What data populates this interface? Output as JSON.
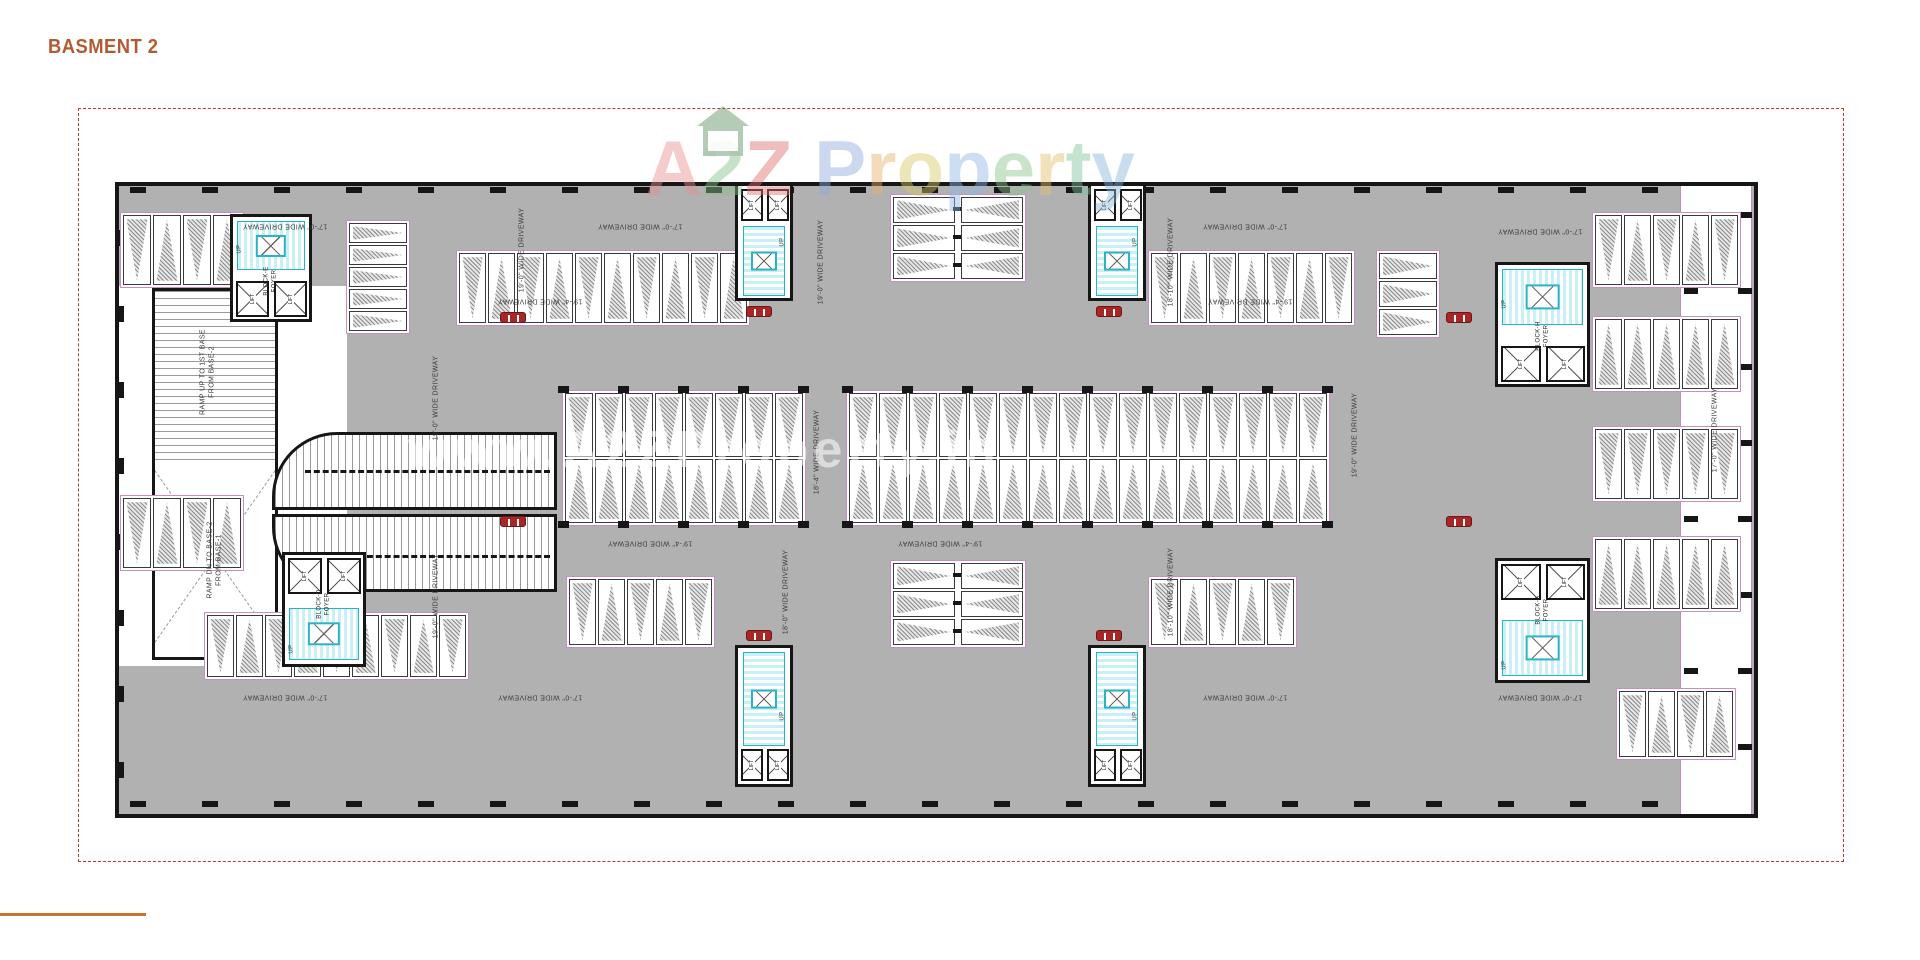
{
  "page": {
    "title": "BASMENT 2",
    "colors": {
      "title": "#b45a32",
      "footer_rule": "#c4742f",
      "boundary": "#c0392b",
      "driveway": "#b2b1b2",
      "wall": "#161616",
      "bay_outline": "#c490c4",
      "hatch": "#8d8d8d",
      "stair_line": "#2bb3c4",
      "stair_fill": "#c8f0f5",
      "car": "#a82626",
      "label": "#3a3a3a"
    }
  },
  "watermark": {
    "brand_letters": [
      {
        "ch": "A",
        "color": "#e78f8f"
      },
      {
        "ch": "2",
        "color": "#85c285"
      },
      {
        "ch": "Z",
        "color": "#e06e6e"
      },
      {
        "ch": " ",
        "color": "#ffffff"
      },
      {
        "ch": "P",
        "color": "#8fa8e0"
      },
      {
        "ch": "r",
        "color": "#e8b06a"
      },
      {
        "ch": "o",
        "color": "#d9c866"
      },
      {
        "ch": "p",
        "color": "#8fb6e8"
      },
      {
        "ch": "e",
        "color": "#8cc48c"
      },
      {
        "ch": "r",
        "color": "#e3c06a"
      },
      {
        "ch": "t",
        "color": "#7fc29b"
      },
      {
        "ch": "y",
        "color": "#86b6da"
      }
    ],
    "url": "www.A2ZProperty.in"
  },
  "plan": {
    "lift_label": "LIFT",
    "up_label": "UP",
    "ramp_labels": {
      "up": "RAMP UP TO 1ST BASE\nFROM BASE-2",
      "down": "RAMP DN TO BASE-2\nFROM BASE-1"
    },
    "driveway_labels": [
      {
        "text": "17'-0\" WIDE DRIVEWAY",
        "x": 285,
        "y": 225,
        "rot": 180
      },
      {
        "text": "17'-0\" WIDE DRIVEWAY",
        "x": 640,
        "y": 225,
        "rot": 180
      },
      {
        "text": "17'-0\" WIDE DRIVEWAY",
        "x": 1245,
        "y": 225,
        "rot": 180
      },
      {
        "text": "17'-0\" WIDE DRIVEWAY",
        "x": 1540,
        "y": 230,
        "rot": 180
      },
      {
        "text": "19'-4\" WIDE DRIVEWAY",
        "x": 540,
        "y": 300,
        "rot": 180
      },
      {
        "text": "19'-4\" WIDE DRIVEWAY",
        "x": 1250,
        "y": 300,
        "rot": 180
      },
      {
        "text": "19'-4\" WIDE DRIVEWAY",
        "x": 650,
        "y": 542,
        "rot": 180
      },
      {
        "text": "19'-4\" WIDE DRIVEWAY",
        "x": 940,
        "y": 542,
        "rot": 180
      },
      {
        "text": "17'-0\" WIDE DRIVEWAY",
        "x": 285,
        "y": 696,
        "rot": 180
      },
      {
        "text": "17'-0\" WIDE DRIVEWAY",
        "x": 540,
        "y": 696,
        "rot": 180
      },
      {
        "text": "17'-0\" WIDE DRIVEWAY",
        "x": 1245,
        "y": 696,
        "rot": 180
      },
      {
        "text": "17'-0\" WIDE DRIVEWAY",
        "x": 1540,
        "y": 696,
        "rot": 180
      },
      {
        "text": "19'-0\" WIDE DRIVEWAY",
        "x": 523,
        "y": 250,
        "rot": -90
      },
      {
        "text": "19'-0\" WIDE DRIVEWAY",
        "x": 822,
        "y": 262,
        "rot": -90
      },
      {
        "text": "18'-10\" WIDE DRIVEWAY",
        "x": 1172,
        "y": 262,
        "rot": -90
      },
      {
        "text": "19'-0\" WIDE DRIVEWAY",
        "x": 437,
        "y": 398,
        "rot": -90
      },
      {
        "text": "18'-4\" WIDE DRIVEWAY",
        "x": 818,
        "y": 452,
        "rot": -90
      },
      {
        "text": "19'-0\" WIDE DRIVEWAY",
        "x": 1356,
        "y": 435,
        "rot": -90
      },
      {
        "text": "19'-0\" WIDE DRIVEWAY",
        "x": 437,
        "y": 596,
        "rot": -90
      },
      {
        "text": "18'-0\" WIDE DRIVEWAY",
        "x": 787,
        "y": 592,
        "rot": -90
      },
      {
        "text": "18'-10\" WIDE DRIVEWAY",
        "x": 1172,
        "y": 592,
        "rot": -90
      },
      {
        "text": "17'-0\" WIDE DRIVEWAY",
        "x": 1716,
        "y": 430,
        "rot": -90
      }
    ],
    "cores": [
      {
        "id": "block-e-core",
        "label": "BLOCK-E\nFOYER",
        "x": 230,
        "y": 214,
        "w": 82,
        "h": 108,
        "stair": "top",
        "orient": "h"
      },
      {
        "id": "block-d-core",
        "label": "BLOCK-D\nFOYER",
        "x": 282,
        "y": 552,
        "w": 84,
        "h": 115,
        "stair": "bottom",
        "orient": "h"
      },
      {
        "id": "block-h-core",
        "label": "BLOCK-H\nFOYER",
        "x": 1495,
        "y": 262,
        "w": 95,
        "h": 125,
        "stair": "top",
        "orient": "h"
      },
      {
        "id": "block-a-core",
        "label": "BLOCK-A\nFOYER",
        "x": 1495,
        "y": 558,
        "w": 95,
        "h": 125,
        "stair": "bottom",
        "orient": "h"
      },
      {
        "id": "stair-core-top-1",
        "label": "",
        "x": 735,
        "y": 183,
        "w": 58,
        "h": 118,
        "stair": "bottom",
        "orient": "v"
      },
      {
        "id": "stair-core-top-2",
        "label": "",
        "x": 1088,
        "y": 183,
        "w": 58,
        "h": 118,
        "stair": "bottom",
        "orient": "v"
      },
      {
        "id": "stair-core-bottom-1",
        "label": "",
        "x": 735,
        "y": 645,
        "w": 58,
        "h": 142,
        "stair": "top",
        "orient": "v"
      },
      {
        "id": "stair-core-bottom-2",
        "label": "",
        "x": 1088,
        "y": 645,
        "w": 58,
        "h": 142,
        "stair": "top",
        "orient": "v"
      }
    ],
    "stall_groups": [
      {
        "id": "top-left-row",
        "type": "v",
        "x": 120,
        "y": 212,
        "n": 4,
        "sw": 28,
        "sh": 70,
        "apex": "alt"
      },
      {
        "id": "left-upper-stack",
        "type": "h",
        "x": 346,
        "y": 220,
        "n": 5,
        "sw": 58,
        "sh": 20,
        "apex": "right"
      },
      {
        "id": "top-row-1",
        "type": "v",
        "x": 456,
        "y": 250,
        "n": 10,
        "sw": 27,
        "sh": 70,
        "apex": "alt"
      },
      {
        "id": "top-center-island",
        "type": "hgrid",
        "x": 890,
        "y": 194,
        "cols": 2,
        "rows": 3,
        "sw": 62,
        "sh": 26
      },
      {
        "id": "top-row-2",
        "type": "v",
        "x": 1148,
        "y": 250,
        "n": 7,
        "sw": 27,
        "sh": 70,
        "apex": "alt"
      },
      {
        "id": "right-upper-stack",
        "type": "h",
        "x": 1376,
        "y": 250,
        "n": 3,
        "sw": 58,
        "sh": 26,
        "apex": "right"
      },
      {
        "id": "top-right-row",
        "type": "v",
        "x": 1592,
        "y": 212,
        "n": 5,
        "sw": 27,
        "sh": 70,
        "apex": "alt"
      },
      {
        "id": "right-row-1",
        "type": "v",
        "x": 1592,
        "y": 316,
        "n": 5,
        "sw": 27,
        "sh": 70,
        "apex": "up"
      },
      {
        "id": "right-row-2",
        "type": "v",
        "x": 1592,
        "y": 426,
        "n": 5,
        "sw": 27,
        "sh": 70,
        "apex": "down"
      },
      {
        "id": "right-row-3",
        "type": "v",
        "x": 1592,
        "y": 536,
        "n": 5,
        "sw": 27,
        "sh": 70,
        "apex": "up"
      },
      {
        "id": "central-block-1",
        "type": "grid2",
        "x": 562,
        "y": 390,
        "cols": 8,
        "sw": 28,
        "sh": 64
      },
      {
        "id": "central-block-2",
        "type": "grid2",
        "x": 846,
        "y": 390,
        "cols": 16,
        "sw": 28,
        "sh": 64
      },
      {
        "id": "bottom-left-corner-row",
        "type": "v",
        "x": 120,
        "y": 495,
        "n": 4,
        "sw": 28,
        "sh": 70,
        "apex": "alt"
      },
      {
        "id": "bottom-row-left",
        "type": "v",
        "x": 204,
        "y": 612,
        "n": 9,
        "sw": 27,
        "sh": 62,
        "apex": "alt"
      },
      {
        "id": "bottom-row-mid-left",
        "type": "v",
        "x": 566,
        "y": 576,
        "n": 5,
        "sw": 27,
        "sh": 66,
        "apex": "alt"
      },
      {
        "id": "bottom-center-island",
        "type": "hgrid",
        "x": 890,
        "y": 560,
        "cols": 2,
        "rows": 3,
        "sw": 62,
        "sh": 26
      },
      {
        "id": "bottom-row-mid-right",
        "type": "v",
        "x": 1148,
        "y": 576,
        "n": 5,
        "sw": 27,
        "sh": 66,
        "apex": "alt"
      },
      {
        "id": "bottom-right-corner-row",
        "type": "v",
        "x": 1616,
        "y": 688,
        "n": 4,
        "sw": 27,
        "sh": 66,
        "apex": "alt"
      }
    ],
    "cars": [
      {
        "x": 500,
        "y": 312
      },
      {
        "x": 746,
        "y": 306
      },
      {
        "x": 1096,
        "y": 306
      },
      {
        "x": 1446,
        "y": 312
      },
      {
        "x": 500,
        "y": 516
      },
      {
        "x": 746,
        "y": 630
      },
      {
        "x": 1096,
        "y": 630
      },
      {
        "x": 1446,
        "y": 516
      }
    ]
  }
}
